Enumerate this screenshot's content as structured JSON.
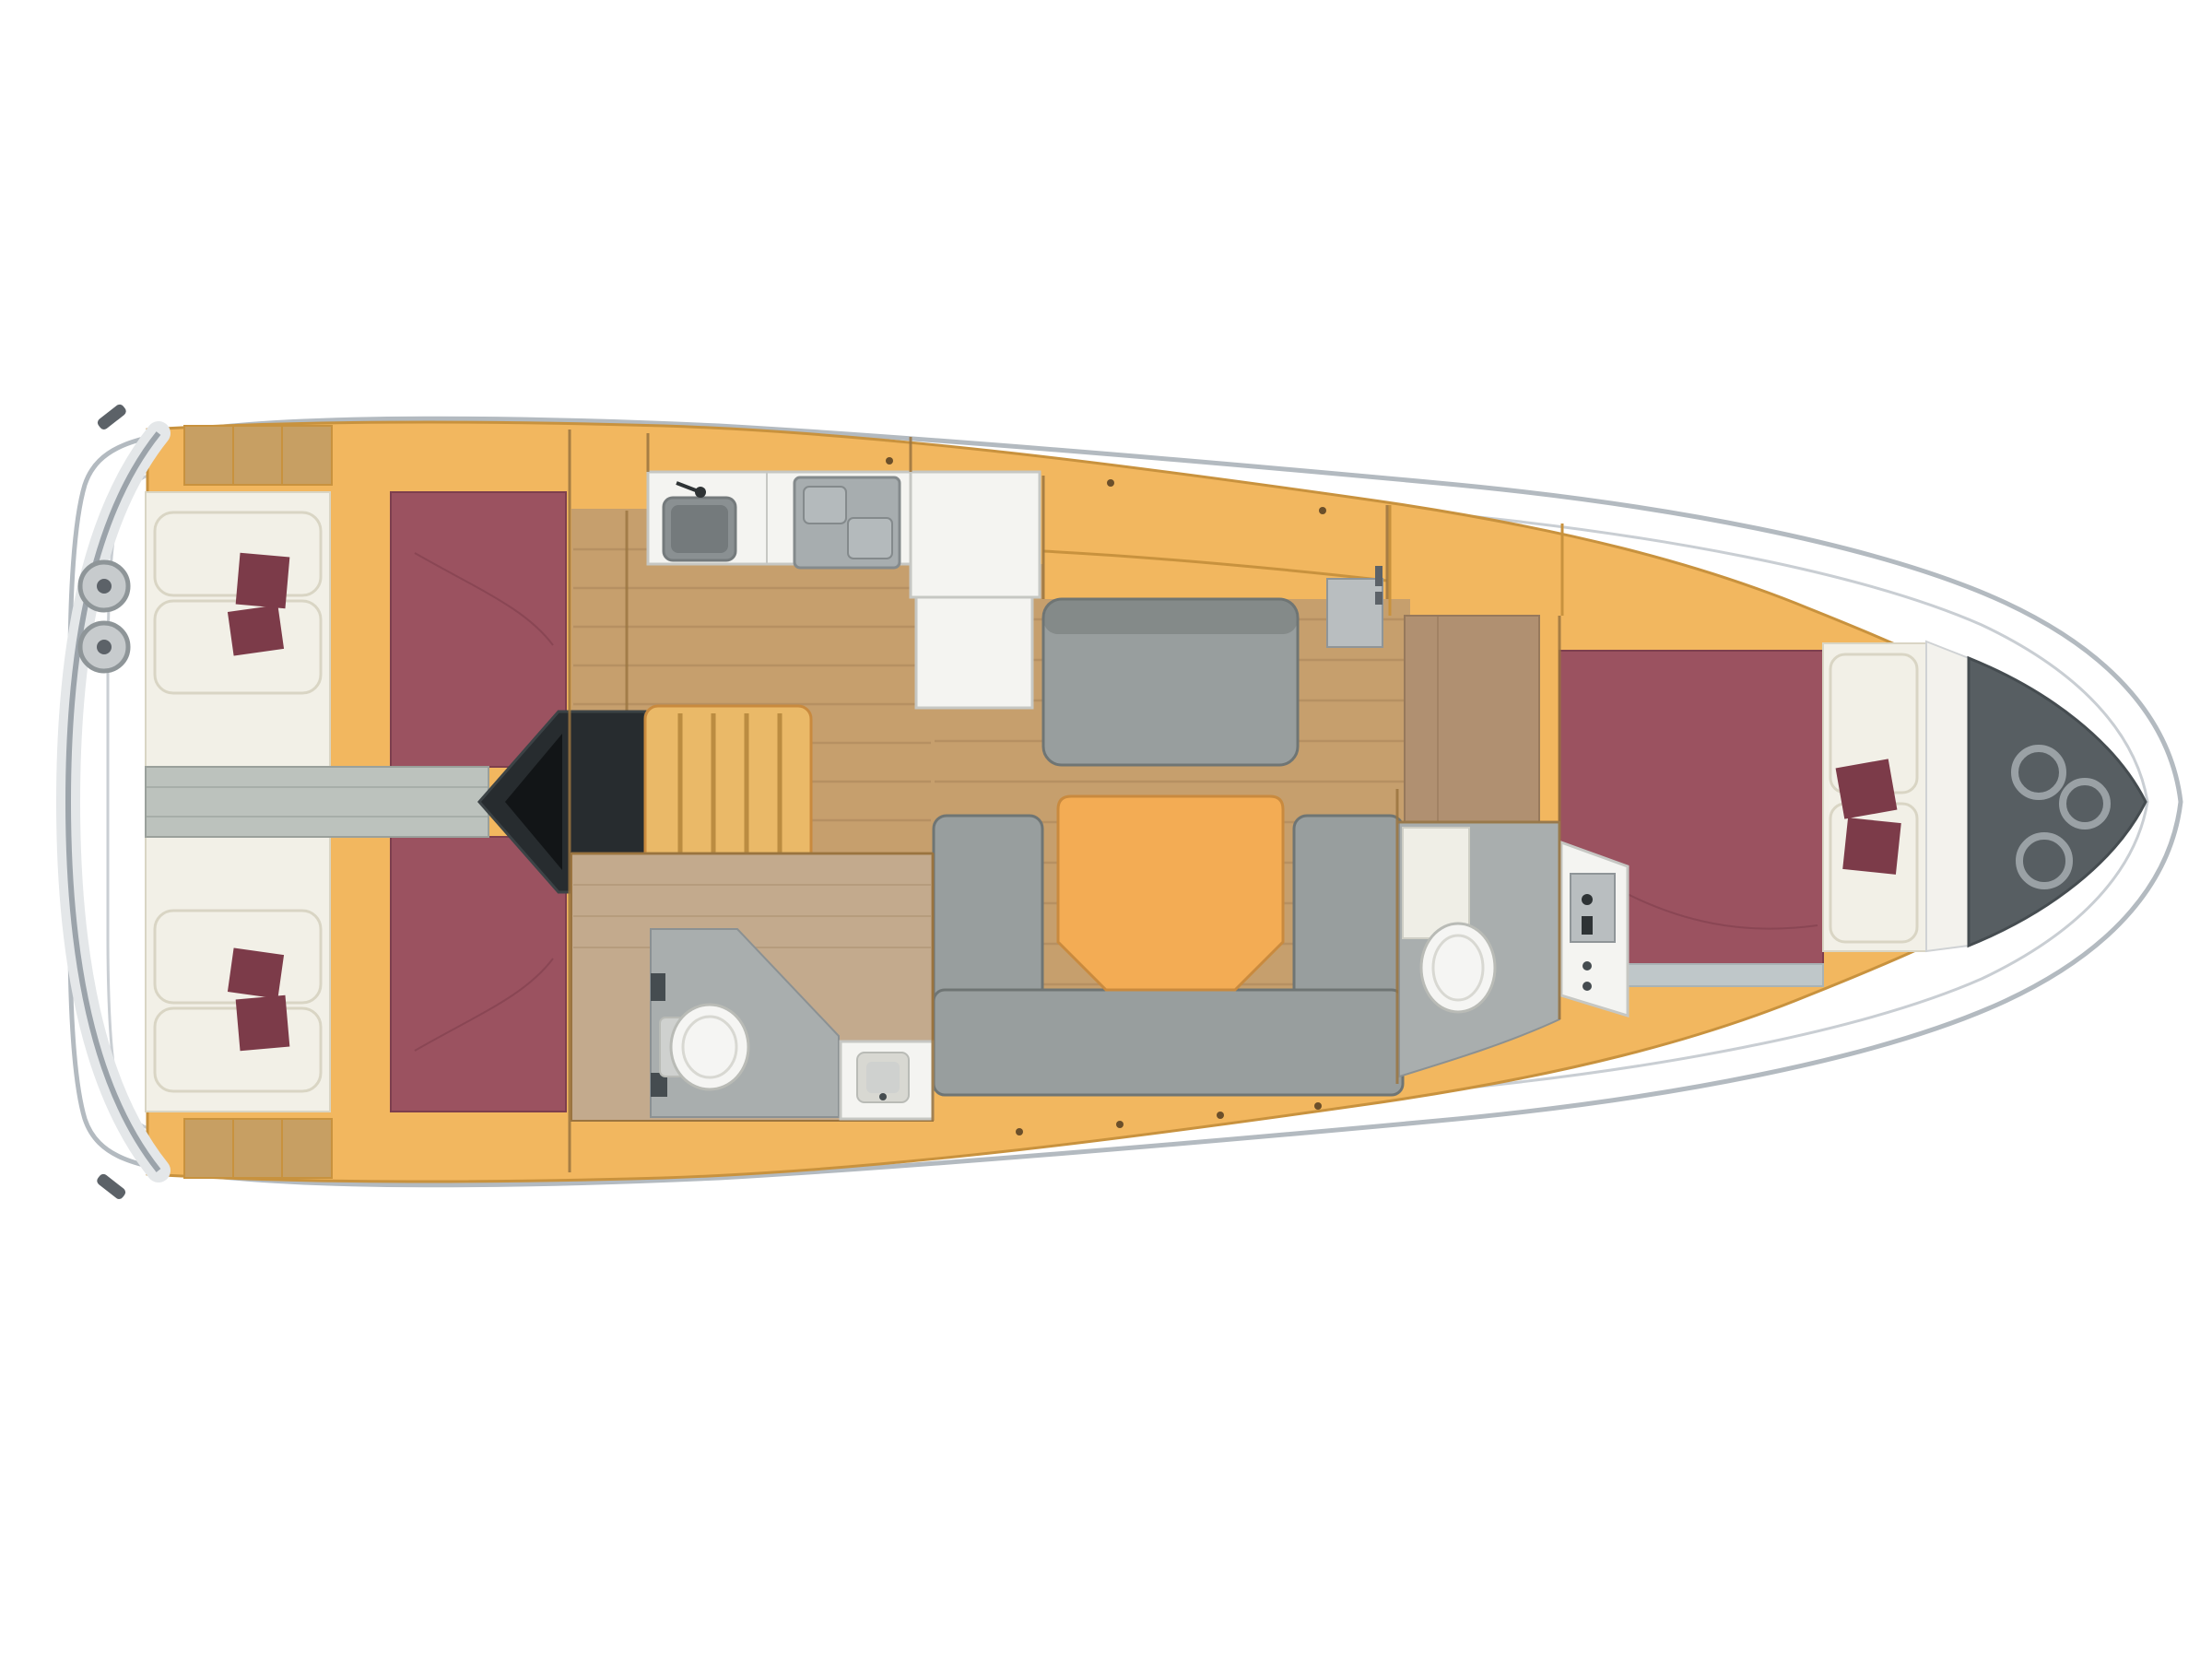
{
  "vessel": {
    "kind": "sailing-yacht-interior-floor-plan",
    "orientation": "bow-right-stern-left",
    "rooms": [
      {
        "id": "stern-deck",
        "features": [
          "swim-platform-arc",
          "corner-cleat",
          "round-deck-fitting",
          "round-deck-fitting"
        ]
      },
      {
        "id": "aft-cabin-port",
        "features": [
          "double-berth-mattress",
          "pillows",
          "decor-cushions",
          "stern-lockers"
        ]
      },
      {
        "id": "aft-cabin-starboard",
        "features": [
          "double-berth-mattress",
          "pillows",
          "decor-cushions",
          "stern-lockers"
        ]
      },
      {
        "id": "companionway",
        "features": [
          "engine-compartment",
          "companionway-steps",
          "center-corridor"
        ]
      },
      {
        "id": "galley",
        "features": [
          "counter",
          "sink",
          "faucet",
          "stove-two-burner",
          "fridge-counter-l"
        ]
      },
      {
        "id": "salon",
        "features": [
          "port-settee",
          "shelf-locker",
          "u-shaped-sofa",
          "dining-table"
        ]
      },
      {
        "id": "aft-head",
        "features": [
          "wet-floor",
          "shower-tray",
          "toilet",
          "washbasin-vanity"
        ]
      },
      {
        "id": "forward-passage",
        "features": [
          "wardrobe",
          "dresser"
        ]
      },
      {
        "id": "forward-head",
        "features": [
          "wet-floor",
          "door-leaf",
          "toilet",
          "vanity-console",
          "instrument-panel"
        ]
      },
      {
        "id": "forward-cabin",
        "features": [
          "v-berth-mattress",
          "pillows",
          "decor-cushions",
          "berth-step"
        ]
      },
      {
        "id": "bow",
        "features": [
          "forepeak-bulkhead",
          "anchor-locker",
          "mooring-ring",
          "mooring-ring",
          "mooring-ring"
        ]
      }
    ]
  },
  "palette": {
    "white": "#ffffff",
    "hullStroke": "#b3bac0",
    "deckLine": "#c9ced3",
    "sternShadeSoft": "#e4e7e9",
    "transomArc": "#9ba3aa",
    "fittingGray": "#c7cbcd",
    "fittingRim": "#8e9598",
    "fittingDark": "#5c6268",
    "interiorOrange": "#f2b75f",
    "orangeSeam": "#c8923e",
    "woodFloor": "#c69f6d",
    "woodLine": "#a9845a",
    "lockerWood": "#c79f63",
    "mattress": "#9b5260",
    "mattressEdge": "#7e3f4d",
    "cushionDark": "#7c3b49",
    "beddingWhite": "#f2f0e7",
    "beddingEdge": "#d9d5c4",
    "sofaGray": "#989e9e",
    "sofaEdge": "#6f7574",
    "tableOrange": "#f3ac54",
    "tableEdge": "#c98a3e",
    "counterWhite": "#f4f4f1",
    "counterEdge": "#c6c7c3",
    "sinkGray": "#8a9092",
    "sinkDark": "#747a7c",
    "stoveGray": "#a7adaf",
    "stovePad": "#b4babc",
    "stovePadEdge": "#848a8c",
    "headFloor": "#c3aa8d",
    "headLine": "#a98e6d",
    "showerGray": "#a9aeae",
    "showerEdge": "#8b9193",
    "toiletWhite": "#f5f5f3",
    "toiletEdge": "#b9bbb6",
    "toiletInner": "#d8d8d2",
    "tankGray": "#cfd1cf",
    "engineDark": "#272c2f",
    "engineDarker": "#121517",
    "engineTrim": "#3c4346",
    "stepsOrange": "#eab968",
    "stepsTread": "#bb8c41",
    "anchorDark": "#575e62",
    "anchorEdge": "#454c50",
    "ringGray": "#9aa1a5",
    "corridorGray": "#bcc2bd",
    "corridorEdge": "#9aa09b",
    "dresserTan": "#b09071",
    "dresserEdge": "#97795b",
    "stepStrip": "#bfc7c9",
    "stepStripEdge": "#a9b2b4",
    "bulkhead": "#9a7440",
    "panelGray": "#b9bec0",
    "panelEdge": "#8f9598",
    "wallWhite": "#f3f2ed",
    "wallEdge": "#cfd2d4",
    "doorWhite": "#efeee6",
    "doorEdge": "#cfcfc5",
    "dotBrown": "#6b4f2a",
    "markDark": "#2e3335"
  }
}
